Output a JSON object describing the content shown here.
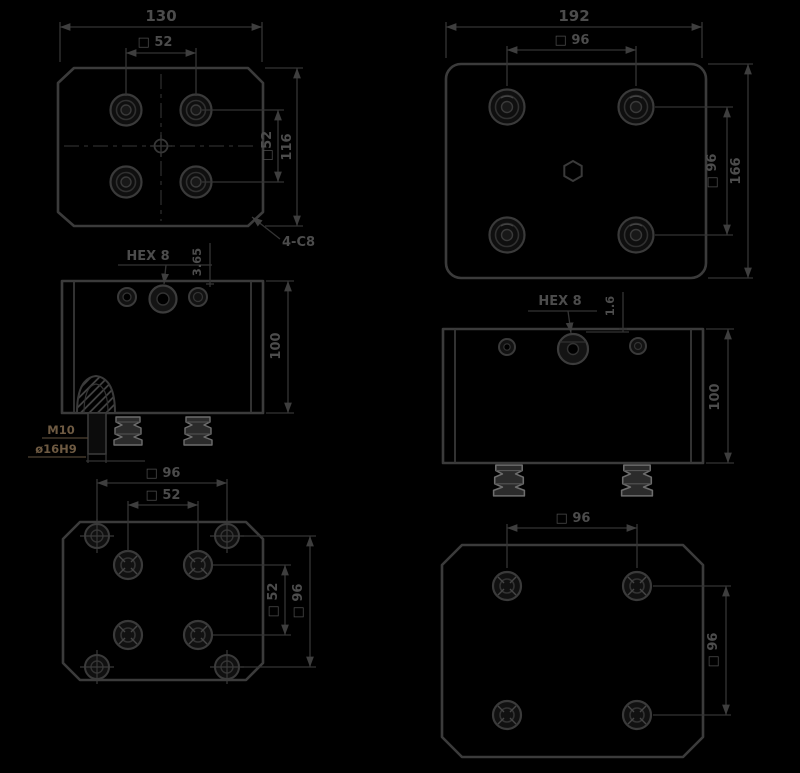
{
  "meta": {
    "type": "technical-drawing",
    "description": "Six-view dimensioned CAD drawing of two rubber mount plates (plan, elevation, bottom views)"
  },
  "colors": {
    "background": "#000000",
    "line": "#3b3b3b",
    "dimension_text": "#4c4c4c",
    "callout_text": "#6e5a42",
    "foot_highlight": "#6d6d6d"
  },
  "views": {
    "plan_small": {
      "overall_width": "130",
      "bolt_square_top": "□ 52",
      "bolt_square_right": "□52",
      "overall_height": "116",
      "corner_chamfer": "4-C8"
    },
    "plan_large": {
      "overall_width": "192",
      "bolt_square_top": "□ 96",
      "bolt_square_right": "□ 96",
      "overall_height": "166"
    },
    "front_small": {
      "hex_callout": "HEX 8",
      "flange_height": "3.65",
      "body_height": "100",
      "thread_callout": "M10",
      "bore_callout": "ø16H9"
    },
    "front_large": {
      "hex_callout": "HEX 8",
      "flange_height": "1.6",
      "body_height": "100"
    },
    "bottom_small": {
      "outer_square_top": "□ 96",
      "inner_square_top": "□ 52",
      "inner_square_right": "□ 52",
      "outer_square_right": "□ 96"
    },
    "bottom_large": {
      "outer_square_top": "□ 96",
      "outer_square_right": "□ 96"
    }
  }
}
